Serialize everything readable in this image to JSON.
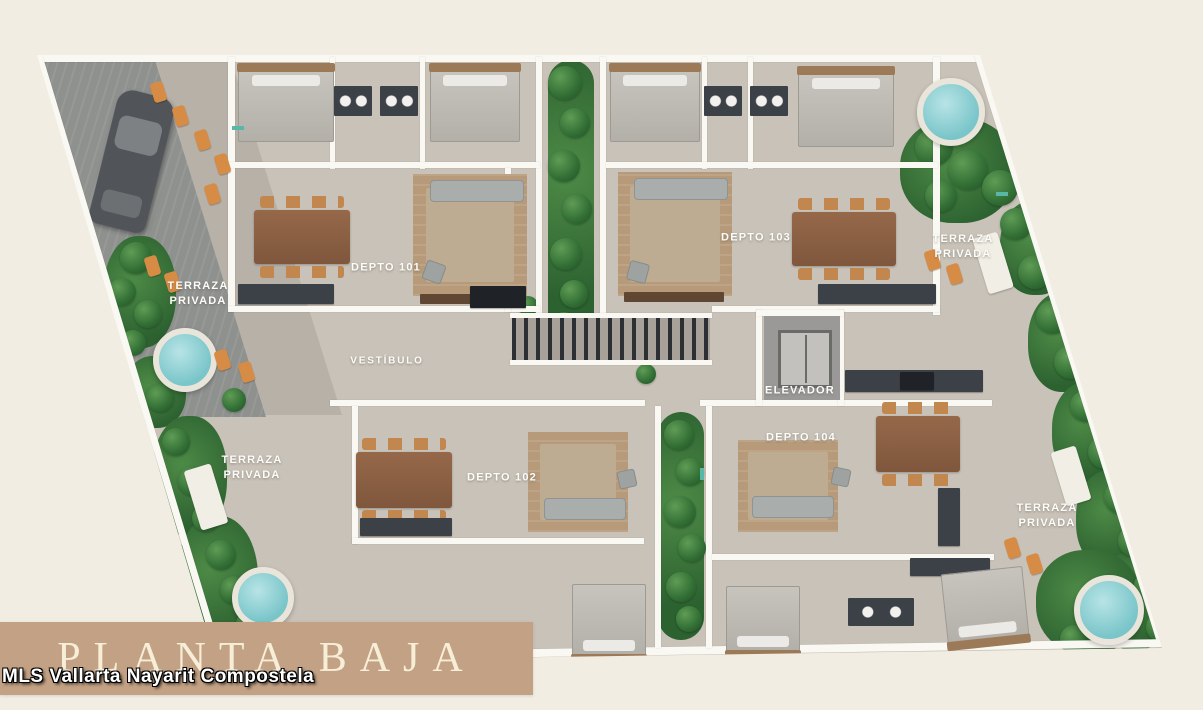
{
  "theme": {
    "page-bg": "#f1ede3",
    "floor": "#c9c2b8",
    "wall": "#faf8f2",
    "green-dark": "#2c6130",
    "green-light": "#5f9c55",
    "pool-fill": "#79c5c9",
    "pool-rim": "#e9e5da",
    "chair-wood": "#c1874f",
    "counter": "#3c4147",
    "sofa": "#a9adab",
    "rug": "#bdac91",
    "deck": "#b69a79",
    "lounger": "#d78c46",
    "garage": "#8f918f",
    "car": "#515458",
    "title-bg": "#c3a184",
    "title-text": "#f7eed8",
    "label-text": "#fcfcf9"
  },
  "title_box": {
    "label": "PLANTA BAJA"
  },
  "watermark": {
    "text": "MLS Vallarta Nayarit Compostela"
  },
  "plan": {
    "units": [
      {
        "label": "DEPTO 101"
      },
      {
        "label": "DEPTO 102"
      },
      {
        "label": "DEPTO 103"
      },
      {
        "label": "DEPTO 104"
      }
    ],
    "rooms": {
      "vestibulo": "VESTÍBULO",
      "elevador": "ELEVADOR",
      "terraza": "TERRAZA\nPRIVADA"
    }
  }
}
